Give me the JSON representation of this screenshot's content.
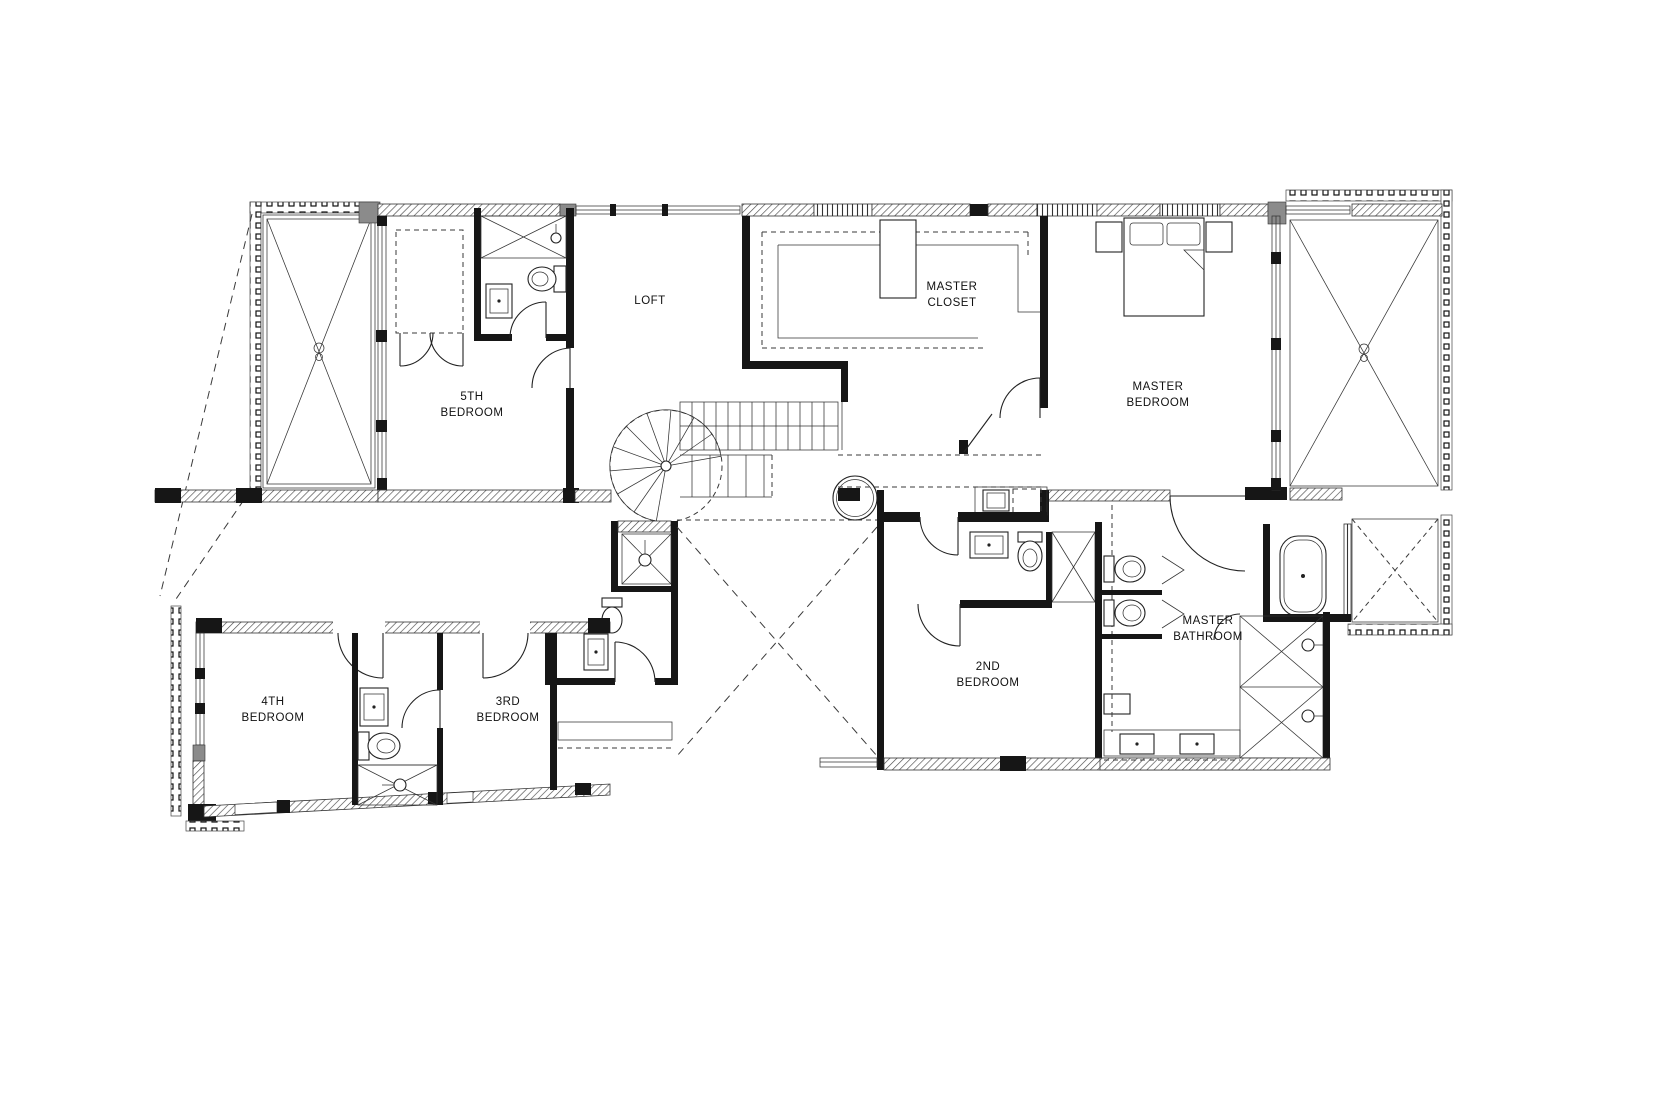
{
  "plan": {
    "type": "architectural-floor-plan",
    "colors": {
      "background": "#ffffff",
      "line": "#1f1f1f",
      "wall": "#161616",
      "hatch": "#555555"
    },
    "rooms": [
      {
        "id": "bedroom5",
        "line1": "5TH",
        "line2": "BEDROOM"
      },
      {
        "id": "loft",
        "line1": "LOFT",
        "line2": ""
      },
      {
        "id": "master_closet",
        "line1": "MASTER",
        "line2": "CLOSET"
      },
      {
        "id": "master_bedroom",
        "line1": "MASTER",
        "line2": "BEDROOM"
      },
      {
        "id": "bedroom4",
        "line1": "4TH",
        "line2": "BEDROOM"
      },
      {
        "id": "bedroom3",
        "line1": "3RD",
        "line2": "BEDROOM"
      },
      {
        "id": "bedroom2",
        "line1": "2ND",
        "line2": "BEDROOM"
      },
      {
        "id": "master_bathroom",
        "line1": "MASTER",
        "line2": "BATHROOM"
      }
    ]
  }
}
